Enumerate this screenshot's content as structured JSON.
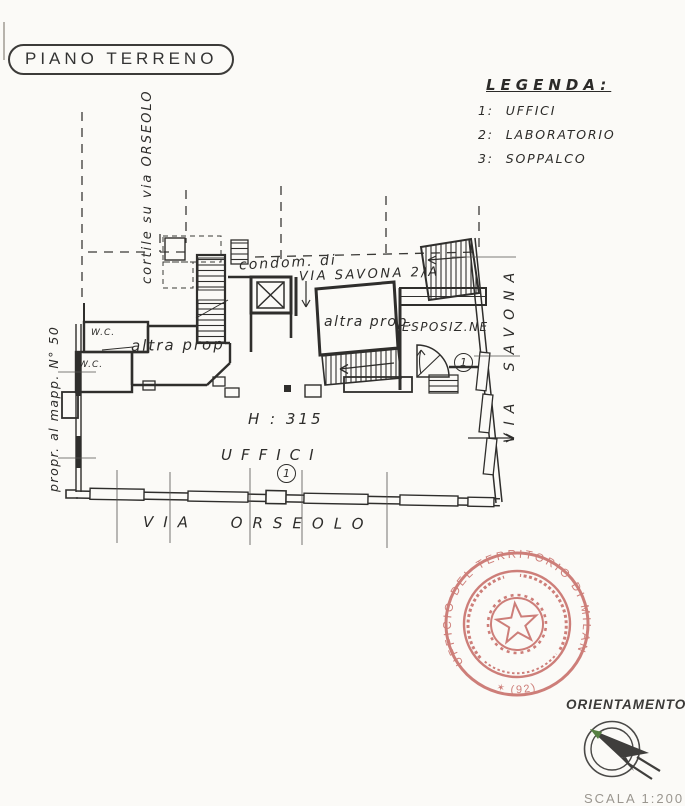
{
  "page": {
    "title": "PIANO TERRENO",
    "scale_note": "SCALA 1:200"
  },
  "legend": {
    "title": "LEGENDA:",
    "items": [
      {
        "num": "1:",
        "label": "UFFICI"
      },
      {
        "num": "2:",
        "label": "LABORATORIO"
      },
      {
        "num": "3:",
        "label": "SOPPALCO"
      }
    ]
  },
  "plan": {
    "labels": {
      "courtyard": "cortile su via ORSEOLO",
      "condominium": "condom. di",
      "condominium_street": "VIA SAVONA 2/A",
      "other_property_left": "altra prop",
      "other_property_right": "altra prop.",
      "showroom": "ESPOSIZ.NE",
      "wc_upper": "W.C.",
      "wc_lower": "W.C.",
      "ceiling_height": "H : 315",
      "offices": "UFFICI",
      "offices_number": "1",
      "showroom_number": "1",
      "street_bottom": "VIA ORSEOLO",
      "street_right": "VIA SAVONA",
      "neighbor_parcel": "propr. al mapp. N° 50"
    },
    "ink_color": "#2f2e2c"
  },
  "stamp": {
    "ring_text": "UFFICIO DEL TERRITORIO DI MILANO",
    "code": "(92)",
    "star": "✶",
    "color": "#c4645e"
  },
  "orientation": {
    "label": "ORIENTAMENTO"
  }
}
